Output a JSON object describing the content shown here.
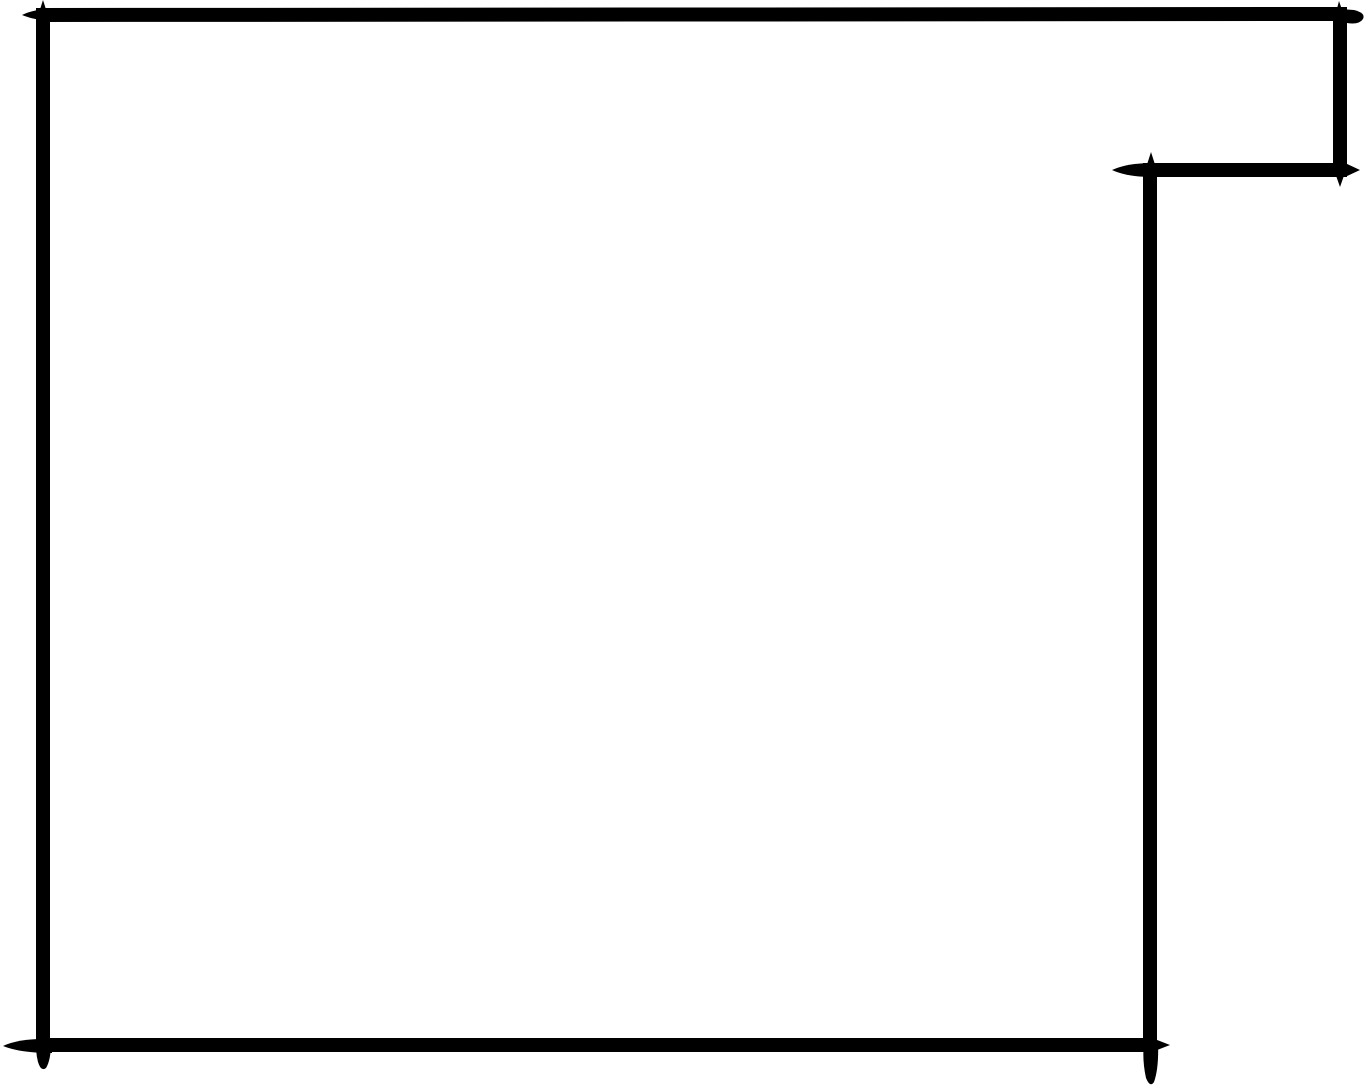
{
  "diagram": {
    "type": "rectilinear-polygon-sketch",
    "canvas": {
      "width": 1367,
      "height": 1087,
      "background": "#ffffff"
    },
    "ink_color": "#000000",
    "stroke_width": 14,
    "outline": {
      "closed": true,
      "vertices": [
        [
          43,
          15
        ],
        [
          1340,
          14
        ],
        [
          1340,
          170
        ],
        [
          1150,
          170
        ],
        [
          1150,
          1045
        ],
        [
          43,
          1045
        ]
      ]
    },
    "spurs": [
      {
        "name": "spur-top-left-up",
        "d": "M 36 22 L 43 0 L 50 22 Z"
      },
      {
        "name": "spur-top-left-flick",
        "d": "M 22 15 Q 34 9 52 9 L 52 21 Q 34 20 22 15 Z"
      },
      {
        "name": "spur-top-right-up",
        "d": "M 1333 24 L 1339 1 L 1347 24 Z"
      },
      {
        "name": "spur-top-right-bump",
        "d": "M 1340 9 L 1354 10 Q 1366 13 1363 19 Q 1359 25 1347 23 L 1340 21 Z"
      },
      {
        "name": "spur-notch-right-down",
        "d": "M 1333 167 L 1340 187 L 1347 167 Z"
      },
      {
        "name": "spur-notch-right-flick",
        "d": "M 1345 163 L 1360 170 L 1345 177 Z"
      },
      {
        "name": "spur-notch-inner-up",
        "d": "M 1144 174 L 1151 152 L 1158 174 Z"
      },
      {
        "name": "spur-notch-inner-flick",
        "d": "M 1112 170 Q 1127 163 1152 163 L 1152 177 Q 1127 177 1112 170 Z"
      },
      {
        "name": "spur-bottom-right-flick",
        "d": "M 1152 1038 L 1170 1045 L 1152 1052 Z"
      },
      {
        "name": "spur-bottom-right-tail",
        "d": "M 1144 1042 L 1158 1042 Q 1159 1068 1154 1082 Q 1150 1088 1146 1078 Q 1142 1060 1144 1042 Z"
      },
      {
        "name": "spur-bottom-left-flick",
        "d": "M 3 1046 Q 20 1038 52 1039 L 52 1053 Q 20 1053 3 1046 Z"
      },
      {
        "name": "spur-bottom-left-tail",
        "d": "M 37 1042 L 51 1042 Q 51 1060 46 1068 Q 41 1072 38 1062 Q 35 1050 37 1042 Z"
      }
    ]
  }
}
